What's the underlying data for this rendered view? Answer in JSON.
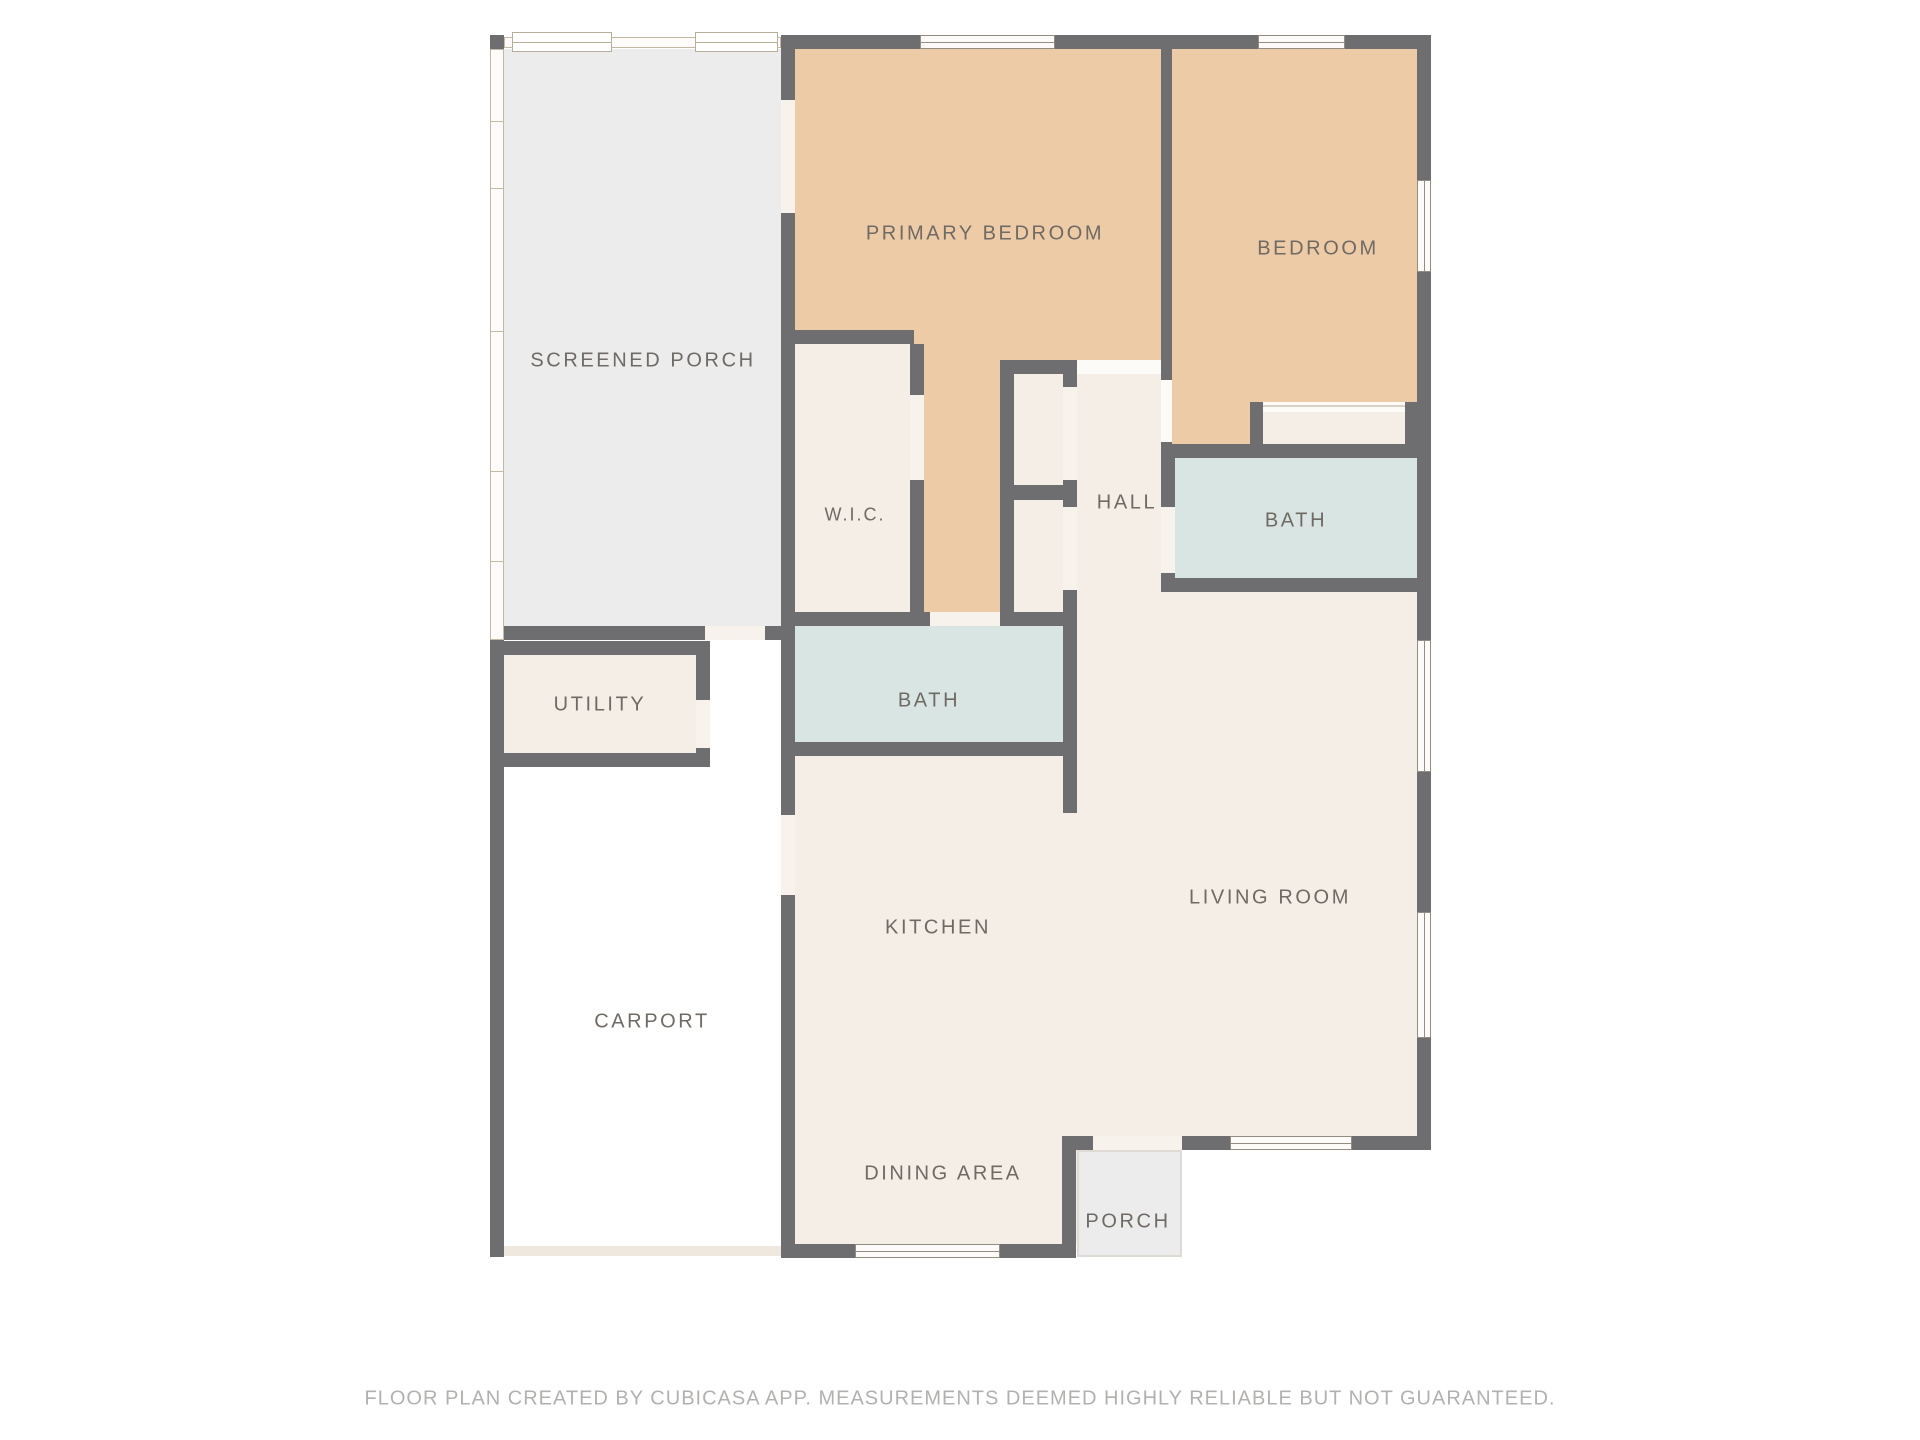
{
  "floorplan": {
    "rooms": [
      {
        "id": "screened-porch",
        "label": "SCREENED PORCH"
      },
      {
        "id": "primary-bedroom",
        "label": "PRIMARY BEDROOM"
      },
      {
        "id": "bedroom",
        "label": "BEDROOM"
      },
      {
        "id": "wic",
        "label": "W.I.C."
      },
      {
        "id": "hall",
        "label": "HALL"
      },
      {
        "id": "bath-hall",
        "label": "BATH"
      },
      {
        "id": "bath-middle",
        "label": "BATH"
      },
      {
        "id": "utility",
        "label": "UTILITY"
      },
      {
        "id": "kitchen",
        "label": "KITCHEN"
      },
      {
        "id": "living-room",
        "label": "LIVING ROOM"
      },
      {
        "id": "carport",
        "label": "CARPORT"
      },
      {
        "id": "dining-area",
        "label": "DINING AREA"
      },
      {
        "id": "porch",
        "label": "PORCH"
      }
    ],
    "footer": "FLOOR PLAN CREATED BY CUBICASA APP. MEASUREMENTS DEEMED HIGHLY RELIABLE BUT NOT GUARANTEED.",
    "colors": {
      "wall": "#6e6e70",
      "bedroom_fill": "#eecba7",
      "bath_fill": "#d9e5e3",
      "floor_fill": "#f4eee6",
      "porch_fill": "#ececed",
      "label_text": "#6f6a64",
      "footer_text": "#b2b1af"
    }
  }
}
